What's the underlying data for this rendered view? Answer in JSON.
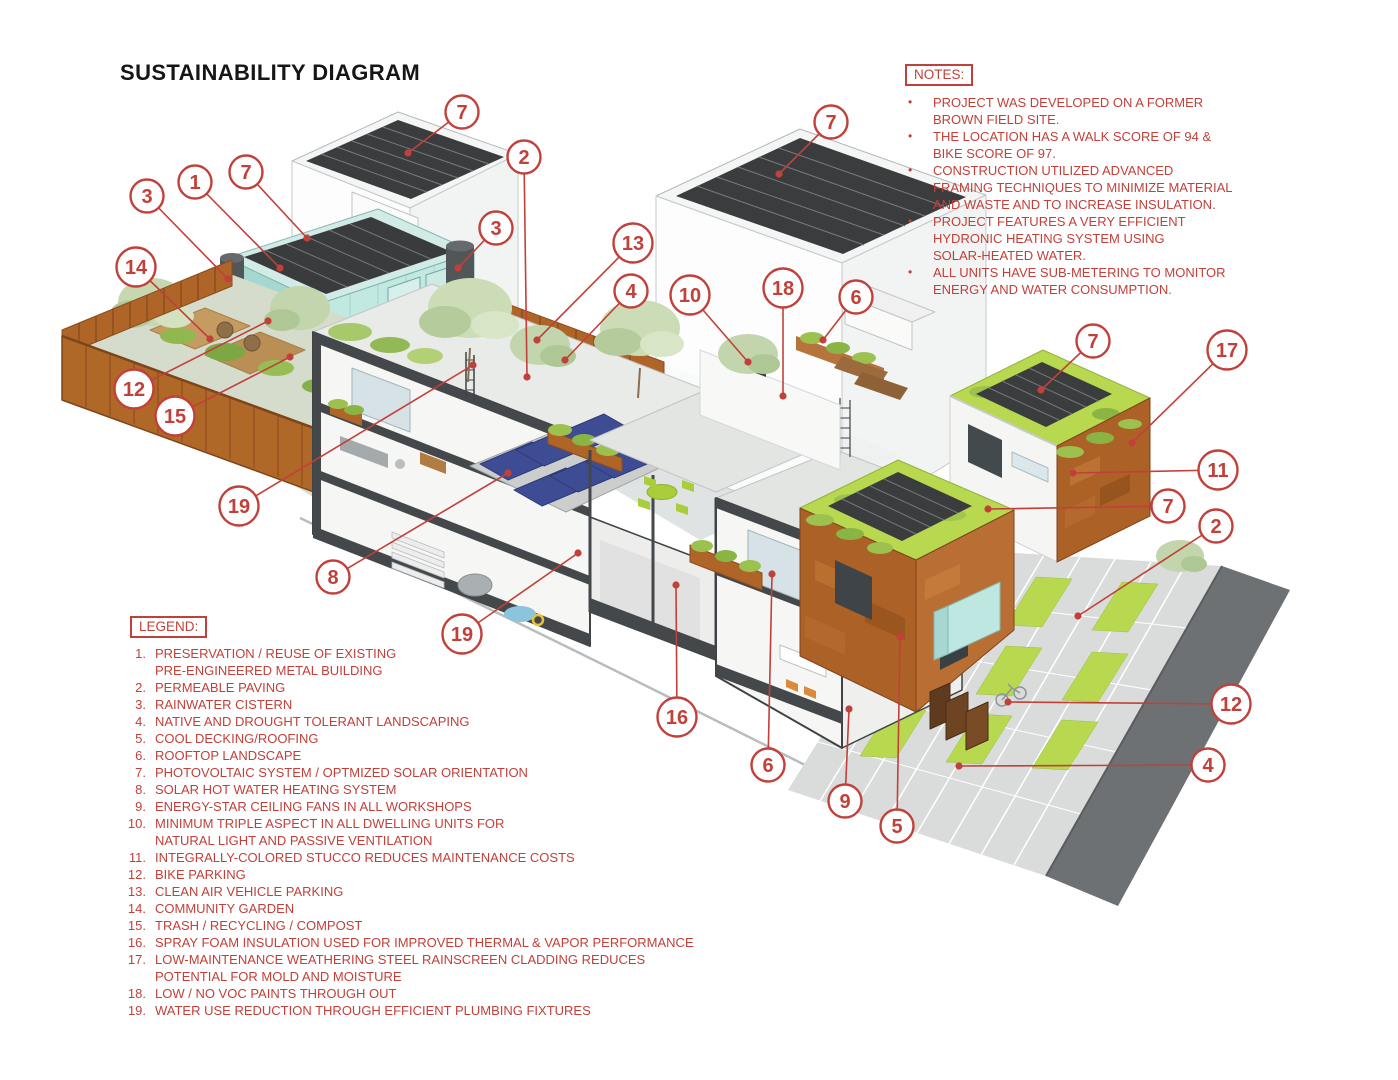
{
  "title": "SUSTAINABILITY DIAGRAM",
  "colors": {
    "accent_red": "#C2403A",
    "teal_building": "#C2E8E2",
    "corten_steel": "#AC6126",
    "rooftop_lime": "#B7D84F",
    "solar_hot_water_navy": "#3E4C93",
    "pv_panel_dark": "#3A3C3E",
    "road_gray": "#6E7173"
  },
  "notes": {
    "label": "NOTES:",
    "items": [
      "PROJECT WAS DEVELOPED ON A FORMER\nBROWN FIELD SITE.",
      "THE LOCATION HAS A WALK SCORE OF 94 &\nBIKE SCORE OF 97.",
      "CONSTRUCTION UTILIZED ADVANCED\nFRAMING TECHNIQUES TO MINIMIZE MATERIAL\nAND WASTE AND TO INCREASE INSULATION.",
      "PROJECT FEATURES A VERY EFFICIENT\nHYDRONIC HEATING SYSTEM USING\nSOLAR-HEATED WATER.",
      "ALL UNITS HAVE SUB-METERING TO MONITOR\nENERGY AND WATER CONSUMPTION."
    ]
  },
  "legend": {
    "label": "LEGEND:",
    "items": [
      {
        "num": "1.",
        "text": "PRESERVATION / REUSE OF EXISTING\nPRE-ENGINEERED METAL BUILDING"
      },
      {
        "num": "2.",
        "text": "PERMEABLE PAVING"
      },
      {
        "num": "3.",
        "text": "RAINWATER CISTERN"
      },
      {
        "num": "4.",
        "text": "NATIVE AND DROUGHT TOLERANT LANDSCAPING"
      },
      {
        "num": "5.",
        "text": "COOL DECKING/ROOFING"
      },
      {
        "num": "6.",
        "text": "ROOFTOP LANDSCAPE"
      },
      {
        "num": "7.",
        "text": "PHOTOVOLTAIC SYSTEM / OPTMIZED SOLAR ORIENTATION"
      },
      {
        "num": "8.",
        "text": "SOLAR HOT WATER HEATING SYSTEM"
      },
      {
        "num": "9.",
        "text": "ENERGY-STAR CEILING FANS IN ALL WORKSHOPS"
      },
      {
        "num": "10.",
        "text": "MINIMUM TRIPLE ASPECT IN ALL DWELLING UNITS FOR\nNATURAL LIGHT AND PASSIVE VENTILATION"
      },
      {
        "num": "11.",
        "text": "INTEGRALLY-COLORED STUCCO REDUCES MAINTENANCE COSTS"
      },
      {
        "num": "12.",
        "text": "BIKE PARKING"
      },
      {
        "num": "13.",
        "text": "CLEAN AIR VEHICLE PARKING"
      },
      {
        "num": "14.",
        "text": "COMMUNITY GARDEN"
      },
      {
        "num": "15.",
        "text": "TRASH / RECYCLING / COMPOST"
      },
      {
        "num": "16.",
        "text": "SPRAY FOAM INSULATION USED FOR IMPROVED THERMAL & VAPOR PERFORMANCE"
      },
      {
        "num": "17.",
        "text": "LOW-MAINTENANCE WEATHERING STEEL RAINSCREEN CLADDING REDUCES\nPOTENTIAL FOR MOLD AND MOISTURE"
      },
      {
        "num": "18.",
        "text": "LOW / NO VOC PAINTS THROUGH OUT"
      },
      {
        "num": "19.",
        "text": "WATER USE REDUCTION THROUGH EFFICIENT PLUMBING FIXTURES"
      }
    ]
  },
  "callouts": [
    {
      "label": "7",
      "x": 462,
      "y": 112,
      "tx": 408,
      "ty": 153
    },
    {
      "label": "2",
      "x": 524,
      "y": 157,
      "tx": 527,
      "ty": 377
    },
    {
      "label": "7",
      "x": 831,
      "y": 122,
      "tx": 779,
      "ty": 174
    },
    {
      "label": "3",
      "x": 147,
      "y": 196,
      "tx": 228,
      "ty": 279
    },
    {
      "label": "1",
      "x": 195,
      "y": 182,
      "tx": 280,
      "ty": 268
    },
    {
      "label": "7",
      "x": 246,
      "y": 172,
      "tx": 307,
      "ty": 238
    },
    {
      "label": "3",
      "x": 496,
      "y": 228,
      "tx": 458,
      "ty": 268
    },
    {
      "label": "13",
      "x": 633,
      "y": 243,
      "tx": 537,
      "ty": 340
    },
    {
      "label": "4",
      "x": 631,
      "y": 291,
      "tx": 565,
      "ty": 360
    },
    {
      "label": "10",
      "x": 690,
      "y": 295,
      "tx": 748,
      "ty": 362
    },
    {
      "label": "18",
      "x": 783,
      "y": 288,
      "tx": 783,
      "ty": 396
    },
    {
      "label": "6",
      "x": 856,
      "y": 297,
      "tx": 823,
      "ty": 340
    },
    {
      "label": "14",
      "x": 136,
      "y": 267,
      "tx": 210,
      "ty": 339
    },
    {
      "label": "12",
      "x": 134,
      "y": 389,
      "tx": 268,
      "ty": 321
    },
    {
      "label": "15",
      "x": 175,
      "y": 416,
      "tx": 290,
      "ty": 357
    },
    {
      "label": "19",
      "x": 239,
      "y": 506,
      "tx": 473,
      "ty": 365
    },
    {
      "label": "8",
      "x": 333,
      "y": 577,
      "tx": 508,
      "ty": 473
    },
    {
      "label": "19",
      "x": 462,
      "y": 634,
      "tx": 578,
      "ty": 553
    },
    {
      "label": "16",
      "x": 677,
      "y": 717,
      "tx": 676,
      "ty": 585
    },
    {
      "label": "6",
      "x": 768,
      "y": 765,
      "tx": 772,
      "ty": 574
    },
    {
      "label": "9",
      "x": 845,
      "y": 801,
      "tx": 849,
      "ty": 709
    },
    {
      "label": "5",
      "x": 897,
      "y": 826,
      "tx": 900,
      "ty": 637
    },
    {
      "label": "7",
      "x": 1093,
      "y": 341,
      "tx": 1041,
      "ty": 390
    },
    {
      "label": "17",
      "x": 1227,
      "y": 350,
      "tx": 1132,
      "ty": 443
    },
    {
      "label": "11",
      "x": 1218,
      "y": 470,
      "tx": 1073,
      "ty": 473
    },
    {
      "label": "7",
      "x": 1168,
      "y": 506,
      "tx": 988,
      "ty": 509
    },
    {
      "label": "2",
      "x": 1216,
      "y": 526,
      "tx": 1078,
      "ty": 616
    },
    {
      "label": "12",
      "x": 1231,
      "y": 704,
      "tx": 1008,
      "ty": 702
    },
    {
      "label": "4",
      "x": 1208,
      "y": 765,
      "tx": 959,
      "ty": 766
    }
  ]
}
